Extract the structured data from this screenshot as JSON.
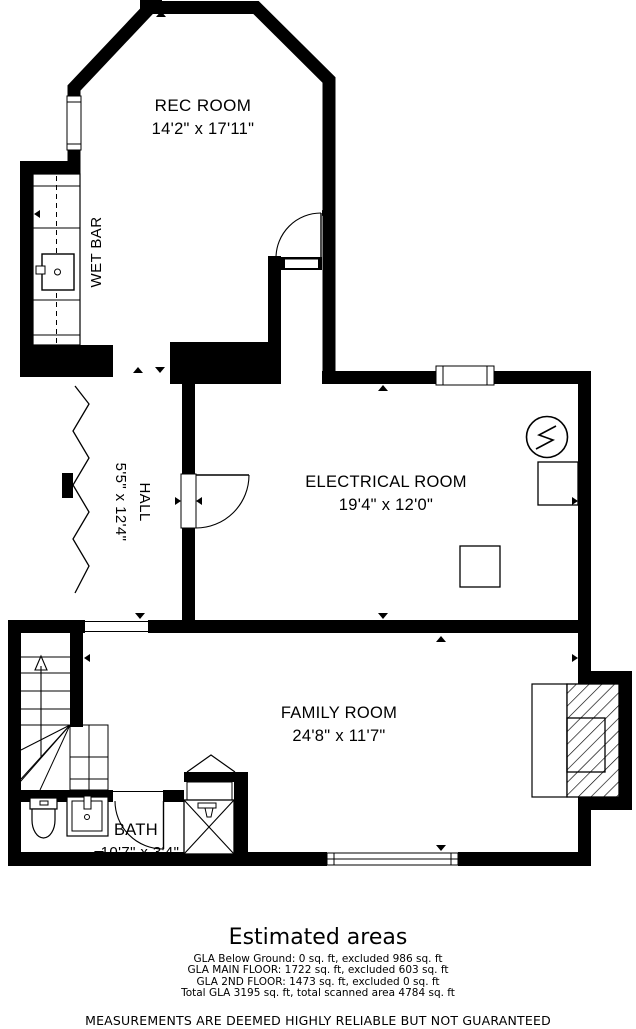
{
  "plan": {
    "colors": {
      "walls": "#000000",
      "background": "#ffffff",
      "lines": "#000000"
    },
    "rooms": {
      "rec_room": {
        "name": "REC ROOM",
        "dims": "14'2\" x 17'11\""
      },
      "wet_bar": {
        "name": "WET BAR"
      },
      "hall": {
        "name": "HALL",
        "dims": "5'5\" x 12'4\""
      },
      "electrical_room": {
        "name": "ELECTRICAL ROOM",
        "dims": "19'4\" x 12'0\""
      },
      "family_room": {
        "name": "FAMILY ROOM",
        "dims": "24'8\" x 11'7\""
      },
      "bath": {
        "name": "BATH",
        "dims": "10'7\" x 3'4\""
      }
    },
    "icons": {
      "electrical_meter": "circle-with-lightning-bolt",
      "shower": "crossed-square-with-shower-head",
      "fireplace": "diagonal-hatched-box",
      "stairs_direction": "up-arrow",
      "wet_bar_sink": "counter-sink",
      "bath_fixtures": "toilet-and-sink"
    }
  },
  "summary": {
    "title": "Estimated areas",
    "lines": [
      "GLA Below Ground: 0 sq. ft, excluded 986 sq. ft",
      "GLA MAIN FLOOR: 1722 sq. ft, excluded 603 sq. ft",
      "GLA 2ND FLOOR: 1473 sq. ft, excluded 0 sq. ft",
      "Total GLA 3195 sq. ft, total scanned area 4784 sq. ft"
    ]
  },
  "disclaimer": "MEASUREMENTS ARE DEEMED HIGHLY RELIABLE BUT NOT GUARANTEED"
}
